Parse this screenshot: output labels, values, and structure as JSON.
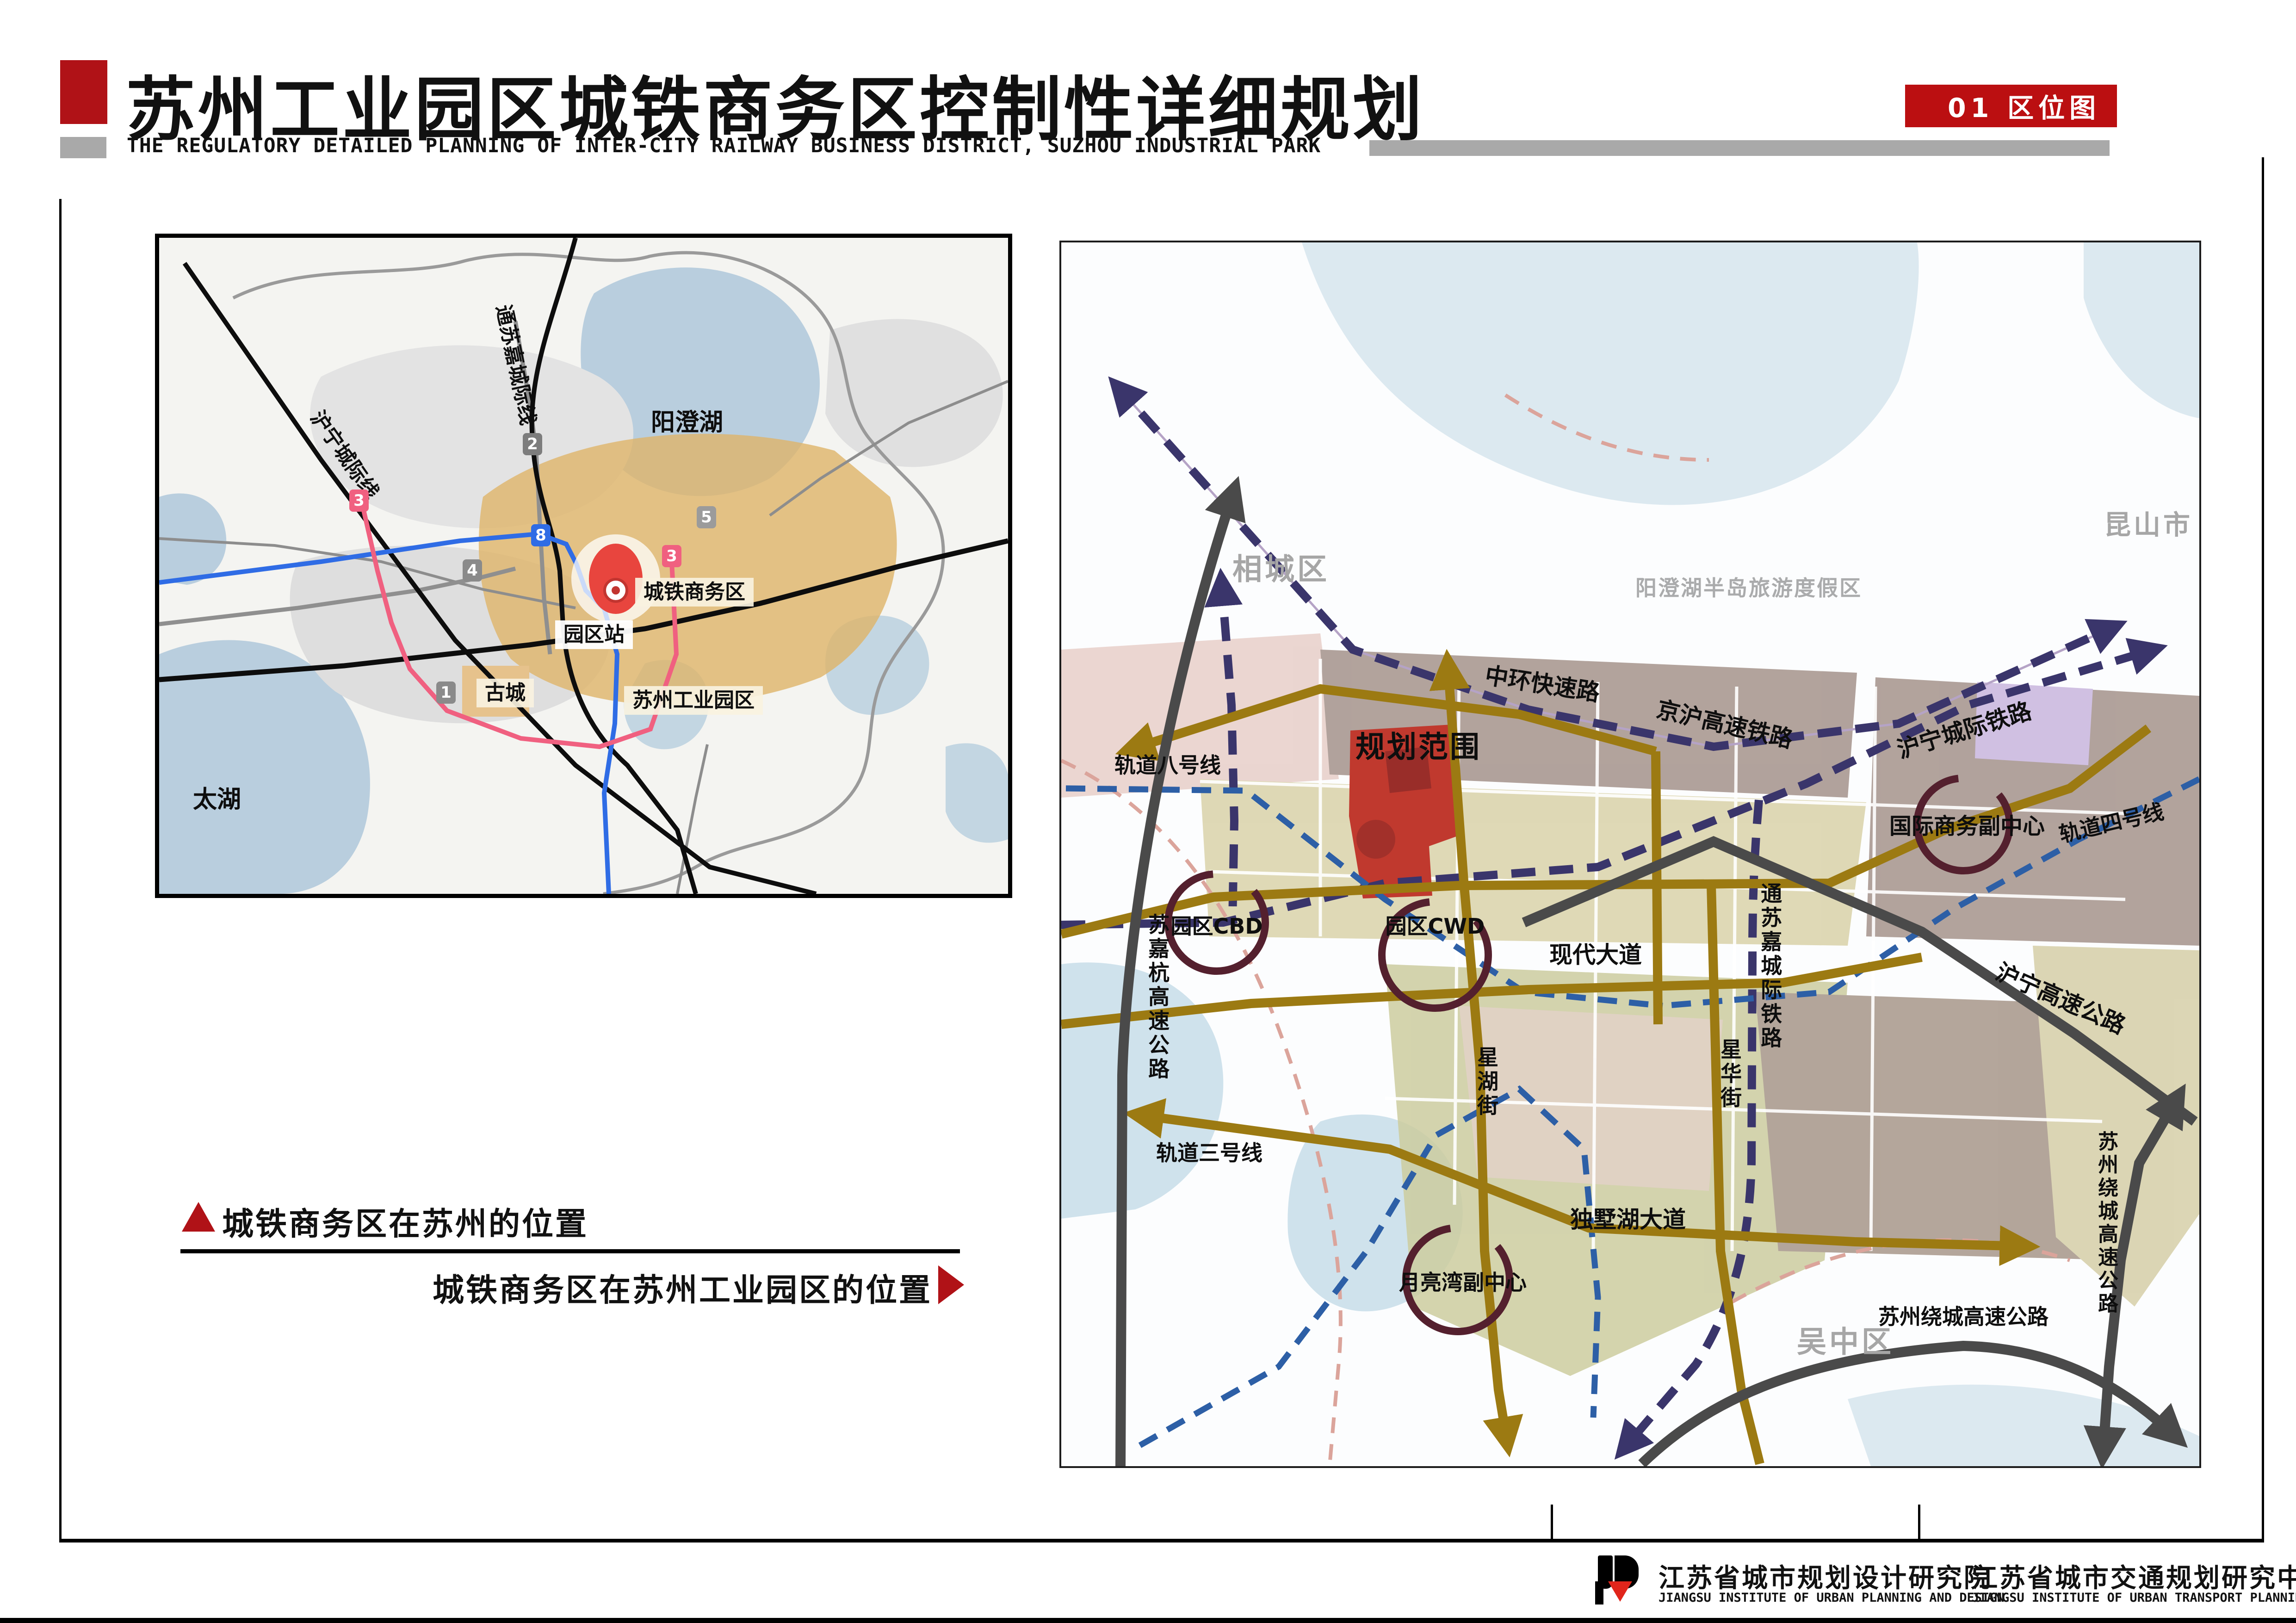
{
  "header": {
    "title": "苏州工业园区城铁商务区控制性详细规划",
    "subtitle": "THE REGULATORY DETAILED PLANNING OF INTER-CITY RAILWAY BUSINESS DISTRICT, SUZHOU INDUSTRIAL PARK",
    "tab": "01 区位图"
  },
  "captions": {
    "line1": "城铁商务区在苏州的位置",
    "line2": "城铁商务区在苏州工业园区的位置"
  },
  "left_map": {
    "labels": [
      {
        "text": "阳澄湖"
      },
      {
        "text": "太湖"
      },
      {
        "text": "沪宁城际线"
      },
      {
        "text": "通苏嘉城际线"
      }
    ],
    "boxes": [
      {
        "text": "城铁商务区"
      },
      {
        "text": "园区站"
      },
      {
        "text": "古城"
      },
      {
        "text": "苏州工业园区"
      }
    ],
    "badges": [
      {
        "num": "8",
        "color": "#2f6ce5"
      },
      {
        "num": "3",
        "color": "#f06080"
      },
      {
        "num": "3",
        "color": "#f06080"
      },
      {
        "num": "4",
        "color": "#8a8a8a"
      },
      {
        "num": "2",
        "color": "#7d7d7d"
      },
      {
        "num": "5",
        "color": "#9b9b9b"
      },
      {
        "num": "1",
        "color": "#8a8a8a"
      }
    ]
  },
  "right_map": {
    "labels": [
      {
        "text": "相城区"
      },
      {
        "text": "昆山市"
      },
      {
        "text": "吴中区"
      },
      {
        "text": "阳澄湖半岛旅游度假区"
      },
      {
        "text": "中环快速路"
      },
      {
        "text": "轨道八号线"
      },
      {
        "text": "京沪高速铁路"
      },
      {
        "text": "沪宁城际铁路"
      },
      {
        "text": "沪宁高速公路"
      },
      {
        "text": "轨道四号线"
      },
      {
        "text": "规划范围"
      },
      {
        "text": "国际商务副中心"
      },
      {
        "text": "现代大道"
      },
      {
        "text": "园区CBD"
      },
      {
        "text": "园区CWD"
      },
      {
        "text": "苏嘉杭高速公路"
      },
      {
        "text": "星湖街"
      },
      {
        "text": "星华街"
      },
      {
        "text": "通苏嘉城际铁路"
      },
      {
        "text": "独墅湖大道"
      },
      {
        "text": "月亮湾副中心"
      },
      {
        "text": "轨道三号线"
      },
      {
        "text": "苏州绕城高速公路"
      },
      {
        "text": "苏州绕城高速公路"
      }
    ]
  },
  "footer": {
    "institutes": [
      {
        "cn": "江苏省城市规划设计研究院",
        "en": "JIANGSU INSTITUTE OF URBAN PLANNING AND DESIGN"
      },
      {
        "cn": "江苏省城市交通规划研究中心",
        "en": "JIANGSU INSTITUTE OF URBAN TRANSPORT PLANNING"
      }
    ]
  },
  "colors": {
    "accent_red": "#b01217",
    "navy_rail": "#3a356b",
    "blue_metro": "#2d5fa6",
    "gold_road": "#9c7a12",
    "dark_highway": "#4a4a4a",
    "ring_dark_red": "#54202e",
    "plan_area_red": "#c0392e"
  }
}
